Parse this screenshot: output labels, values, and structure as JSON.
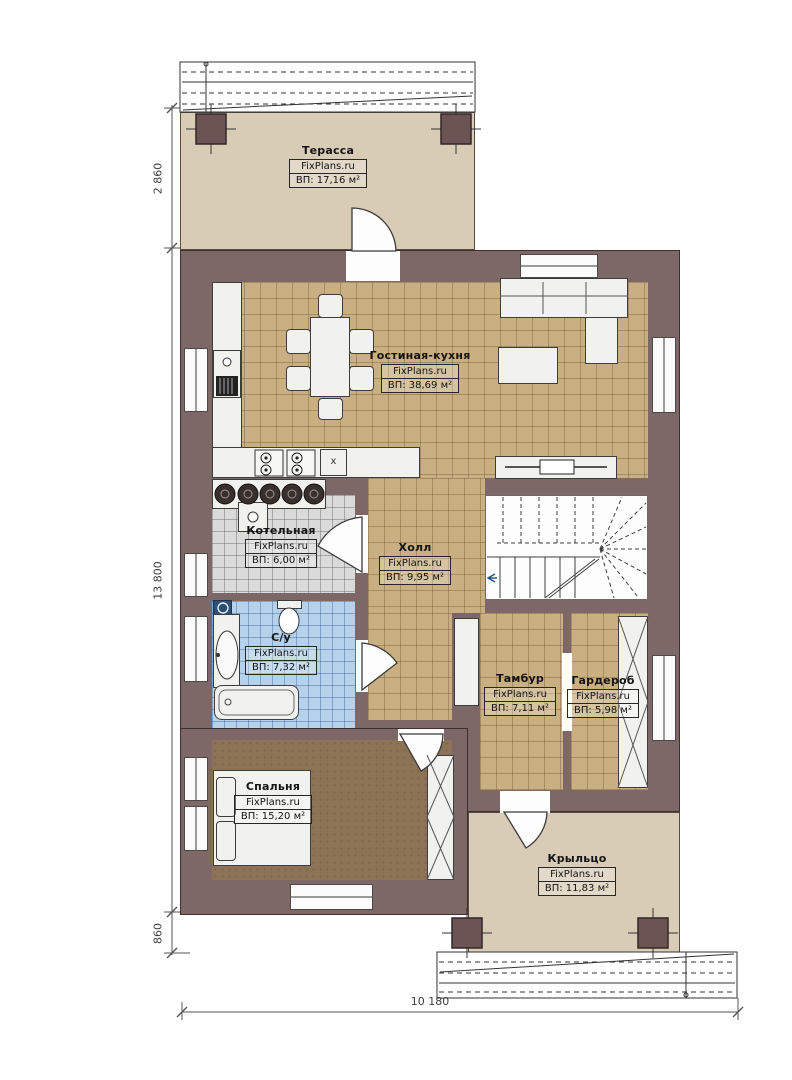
{
  "plan": {
    "brand": "FixPlans.ru",
    "rooms": [
      {
        "id": "terrace",
        "name": "Терасса",
        "brand": "FixPlans.ru",
        "area": "ВП: 17,16 м²"
      },
      {
        "id": "living",
        "name": "Гостиная-кухня",
        "brand": "FixPlans.ru",
        "area": "ВП: 38,69 м²"
      },
      {
        "id": "boiler",
        "name": "Котельная",
        "brand": "FixPlans.ru",
        "area": "ВП: 6,00 м²"
      },
      {
        "id": "hall",
        "name": "Холл",
        "brand": "FixPlans.ru",
        "area": "ВП: 9,95 м²"
      },
      {
        "id": "bathroom",
        "name": "С/у",
        "brand": "FixPlans.ru",
        "area": "ВП: 7,32 м²"
      },
      {
        "id": "tambour",
        "name": "Тамбур",
        "brand": "FixPlans.ru",
        "area": "ВП: 7,11 м²"
      },
      {
        "id": "wardrobe",
        "name": "Гардероб",
        "brand": "FixPlans.ru",
        "area": "ВП: 5,98 м²"
      },
      {
        "id": "bedroom",
        "name": "Спальня",
        "brand": "FixPlans.ru",
        "area": "ВП: 15,20 м²"
      },
      {
        "id": "porch",
        "name": "Крыльцо",
        "brand": "FixPlans.ru",
        "area": "ВП: 11,83 м²"
      }
    ],
    "dimensions": {
      "terrace_height": "2 860",
      "house_height": "13 800",
      "porch_offset": "860",
      "total_width": "10 180"
    },
    "marks": {
      "cabinet_mark": "x"
    },
    "colors": {
      "wall": "#7d6767",
      "tile_tan": "#c9af81",
      "tile_gray": "#dadada",
      "tile_blue": "#b6d1eb",
      "deck": "#d8ccb7",
      "carpet": "#8c7355"
    }
  }
}
